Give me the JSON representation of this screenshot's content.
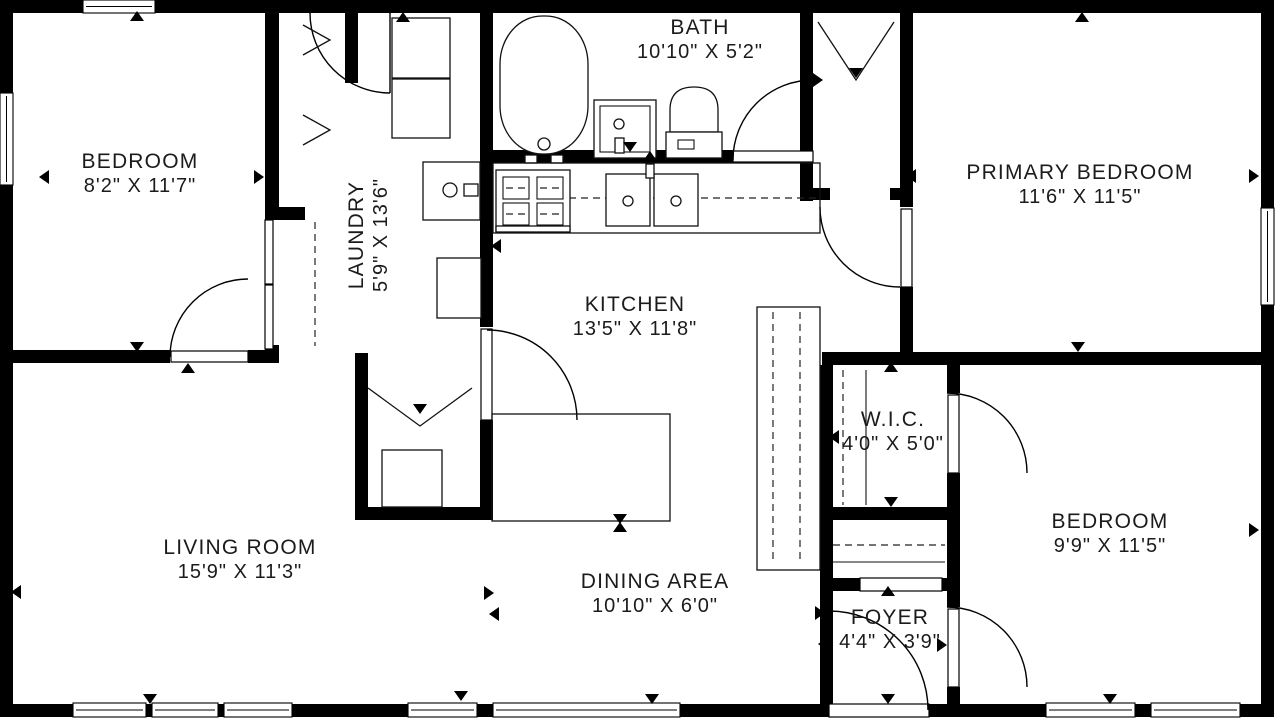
{
  "title": "Single-storey house floor plan",
  "colors": {
    "wall": "#000000",
    "line": "#111111",
    "text": "#1b1b1b",
    "background": "#ffffff"
  },
  "rooms": [
    {
      "id": "bedroom-1",
      "name": "BEDROOM",
      "dims": "8'2\" X 11'7\"",
      "x": 140,
      "y": 172,
      "rotate": 0
    },
    {
      "id": "bath",
      "name": "BATH",
      "dims": "10'10\" X 5'2\"",
      "x": 700,
      "y": 38,
      "rotate": 0
    },
    {
      "id": "primary-bedroom",
      "name": "PRIMARY BEDROOM",
      "dims": "11'6\" X 11'5\"",
      "x": 1080,
      "y": 183,
      "rotate": 0
    },
    {
      "id": "laundry",
      "name": "LAUNDRY",
      "dims": "5'9\" X 13'6\"",
      "x": 367,
      "y": 235,
      "rotate": -90
    },
    {
      "id": "kitchen",
      "name": "KITCHEN",
      "dims": "13'5\" X 11'8\"",
      "x": 635,
      "y": 315,
      "rotate": 0
    },
    {
      "id": "wic",
      "name": "W.I.C.",
      "dims": "4'0\" X 5'0\"",
      "x": 893,
      "y": 430,
      "rotate": 0
    },
    {
      "id": "living-room",
      "name": "LIVING ROOM",
      "dims": "15'9\" X 11'3\"",
      "x": 240,
      "y": 558,
      "rotate": 0
    },
    {
      "id": "dining-area",
      "name": "DINING AREA",
      "dims": "10'10\" X 6'0\"",
      "x": 655,
      "y": 592,
      "rotate": 0
    },
    {
      "id": "foyer",
      "name": "FOYER",
      "dims": "4'4\" X 3'9\"",
      "x": 890,
      "y": 628,
      "rotate": 0
    },
    {
      "id": "bedroom-2",
      "name": "BEDROOM",
      "dims": "9'9\" X 11'5\"",
      "x": 1110,
      "y": 532,
      "rotate": 0
    }
  ],
  "markers": [
    {
      "x": 137,
      "y": 17,
      "dir": "up"
    },
    {
      "x": 403,
      "y": 18,
      "dir": "up"
    },
    {
      "x": 1082,
      "y": 18,
      "dir": "up"
    },
    {
      "x": 45,
      "y": 177,
      "dir": "left"
    },
    {
      "x": 258,
      "y": 177,
      "dir": "right"
    },
    {
      "x": 137,
      "y": 346,
      "dir": "down"
    },
    {
      "x": 188,
      "y": 369,
      "dir": "up"
    },
    {
      "x": 497,
      "y": 246,
      "dir": "left"
    },
    {
      "x": 650,
      "y": 157,
      "dir": "up"
    },
    {
      "x": 630,
      "y": 146,
      "dir": "down"
    },
    {
      "x": 817,
      "y": 80,
      "dir": "right"
    },
    {
      "x": 856,
      "y": 72,
      "dir": "down"
    },
    {
      "x": 912,
      "y": 176,
      "dir": "left"
    },
    {
      "x": 1253,
      "y": 176,
      "dir": "right"
    },
    {
      "x": 1078,
      "y": 346,
      "dir": "down"
    },
    {
      "x": 891,
      "y": 368,
      "dir": "up"
    },
    {
      "x": 891,
      "y": 501,
      "dir": "down"
    },
    {
      "x": 835,
      "y": 437,
      "dir": "left"
    },
    {
      "x": 17,
      "y": 592,
      "dir": "left"
    },
    {
      "x": 488,
      "y": 593,
      "dir": "right"
    },
    {
      "x": 495,
      "y": 614,
      "dir": "left"
    },
    {
      "x": 620,
      "y": 518,
      "dir": "down"
    },
    {
      "x": 620,
      "y": 528,
      "dir": "up"
    },
    {
      "x": 420,
      "y": 408,
      "dir": "down"
    },
    {
      "x": 819,
      "y": 613,
      "dir": "right"
    },
    {
      "x": 824,
      "y": 644,
      "dir": "left"
    },
    {
      "x": 941,
      "y": 645,
      "dir": "right"
    },
    {
      "x": 888,
      "y": 592,
      "dir": "up"
    },
    {
      "x": 888,
      "y": 698,
      "dir": "down"
    },
    {
      "x": 1253,
      "y": 530,
      "dir": "right"
    },
    {
      "x": 1110,
      "y": 698,
      "dir": "down"
    },
    {
      "x": 150,
      "y": 698,
      "dir": "down"
    },
    {
      "x": 461,
      "y": 695,
      "dir": "down"
    },
    {
      "x": 652,
      "y": 698,
      "dir": "down"
    }
  ]
}
